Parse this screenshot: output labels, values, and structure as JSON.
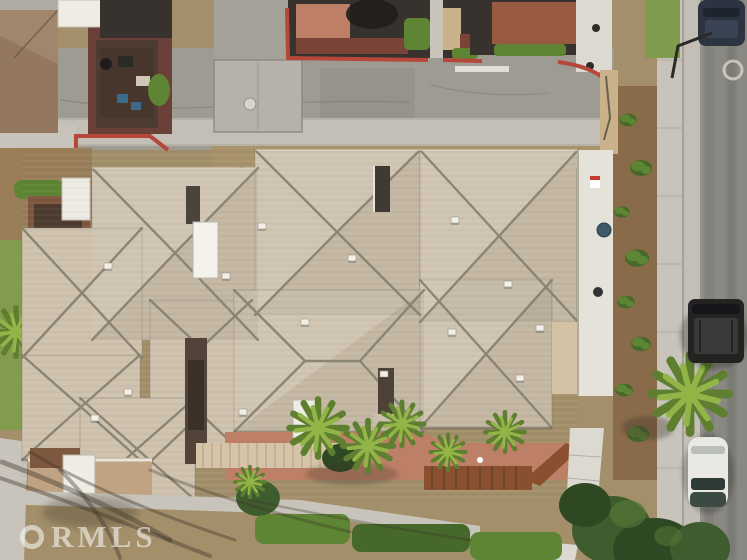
{
  "image": {
    "kind": "aerial-drone-photograph",
    "subject": "Top-down aerial view of a large beige hip-roofed multi-unit residence with front courtyard, palm landscaping, neighboring dark-roofed buildings across a side street, and a vertical street with parked cars on the right",
    "width_px": 747,
    "height_px": 560
  },
  "watermark": {
    "label": "CRMLS",
    "ring": "C",
    "text": "RMLS"
  },
  "palette": {
    "ground": "#a3906b",
    "dirt": "#997e58",
    "dirtDark": "#8a6b49",
    "asphalt": "#9e9b93",
    "asphaltRight": "#92908a",
    "asphaltDark": "#6f6d67",
    "alley": "#a5a29a",
    "concrete": "#c8c4bb",
    "concreteLight": "#dcd9d0",
    "gutter": "#c3bfb6",
    "seam": "#a8a49a",
    "roof": "#cfc2ae",
    "ridge": "#857f6e",
    "eave": "#6e665a",
    "redCurb": "#b5483a",
    "terracotta": "#bd8066",
    "brickRed": "#9a5a42",
    "maroon": "#6b4038",
    "maroonLight": "#7a4438",
    "darkRoof": "#37322d",
    "brownRoof": "#93785f",
    "brownRoofLight": "#a0866c",
    "white": "#efece4",
    "hedge": "#5d8534",
    "hedgeDark": "#46682a",
    "hedgeBright": "#79a23e",
    "palmBright": "#93b548",
    "palmDark": "#5d7f2f",
    "treeDark": "#3f5c2e",
    "treeDarker": "#2f4824",
    "grass": "#7f9c4c",
    "sand": "#c9b289",
    "wood": "#8a4f2e",
    "pergolaLight": "#d6c4a8",
    "pergolaSlat": "#b9a78c",
    "navyCar": "#2c3442",
    "blackCar": "#232322",
    "whiteCar": "#e9e8e3",
    "mustard": "#bfa14f",
    "shadow": "#3a3228",
    "courtyard": "#7e573f",
    "courtyardDark": "#4f3c30",
    "wallLight": "#e5e2d9"
  },
  "scene": {
    "streets": [
      {
        "name": "top-street",
        "surface": "asphalt with concrete gutter, driveway apron, manhole cover and painted white stall line",
        "curb_color": "#b5483a"
      },
      {
        "name": "right-street",
        "surface": "asphalt with dark tire tracks, concrete curb, gutter and sidewalk"
      }
    ],
    "vehicles": [
      {
        "name": "navy-car",
        "description": "dark blue car parked at top right curb"
      },
      {
        "name": "black-suv",
        "description": "black SUV parked mid-right curb"
      },
      {
        "name": "white-car",
        "description": "white sedan parked at lower right curb"
      }
    ],
    "buildings": [
      {
        "name": "main-residence",
        "description": "large beige shingle hip-roof complex with gray ridge lines, roof vents, white skylight and two white chimneys"
      },
      {
        "name": "neighbor-northwest",
        "description": "brown/charcoal roofed unit with walled patio, furniture and BBQ"
      },
      {
        "name": "neighbor-north-center",
        "description": "dark-roofed unit with terracotta patio and hedges"
      },
      {
        "name": "neighbor-northeast",
        "description": "dark-roofed unit with brick-red patio and white walkway"
      }
    ],
    "landscaping": [
      {
        "name": "palms",
        "description": "bright green fan palms along front patio and right sidewalk"
      },
      {
        "name": "hedges",
        "description": "trimmed green hedge rows along front sidewalk"
      },
      {
        "name": "large-tree",
        "description": "dense dark green canopy at bottom right"
      },
      {
        "name": "tree-shadows",
        "description": "long branch shadows cast across bottom-left dirt and sidewalk"
      }
    ],
    "hardscape": [
      {
        "name": "front-patio",
        "description": "terracotta paved courtyard with light trellis and wooden pergola"
      },
      {
        "name": "front-sidewalk",
        "description": "concrete walk running along the bottom of the lot"
      }
    ]
  }
}
